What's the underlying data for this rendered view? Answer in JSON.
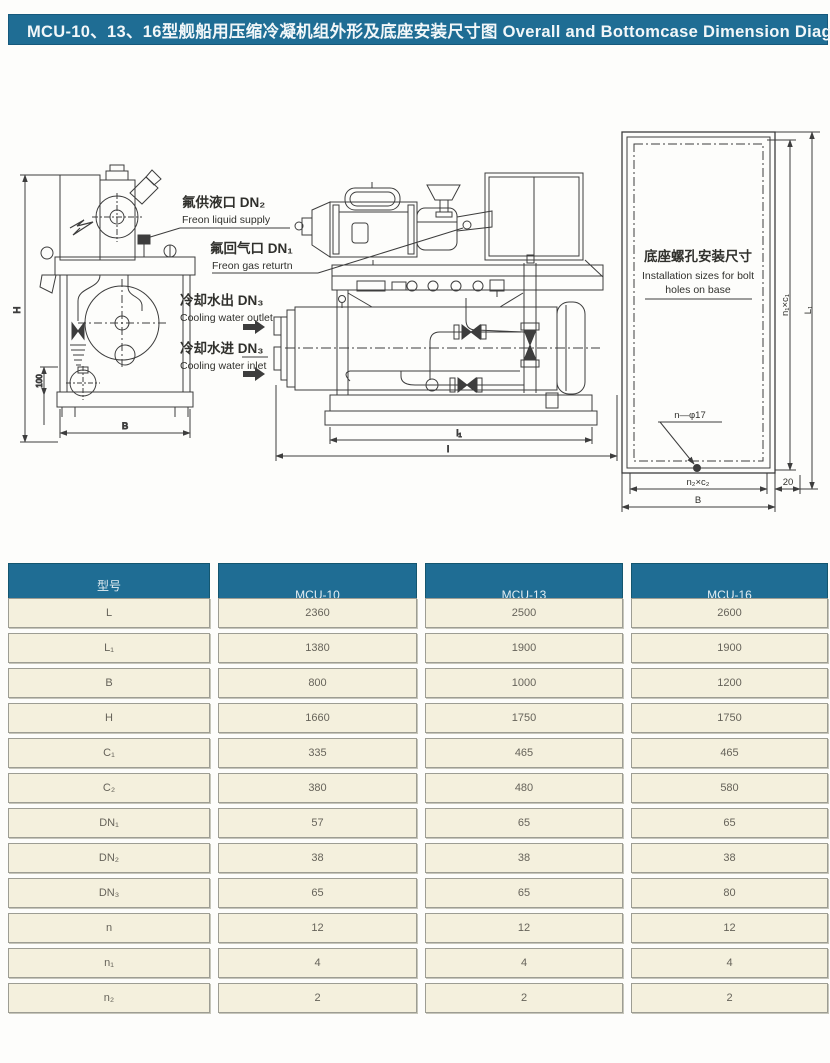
{
  "title_bar": {
    "text": "MCU-10、13、16型舰船用压缩冷凝机组外形及底座安装尺寸图 Overall and Bottomcase Dimension Diagram"
  },
  "colors": {
    "accent_blue": "#1f6d94",
    "cell_cream": "#f4f0dd",
    "drawing_line": "#3d3d3d"
  },
  "diagram": {
    "callouts": {
      "freon_liquid": {
        "zh": "氟供液口 DN₂",
        "en": "Freon liquid supply"
      },
      "freon_gas": {
        "zh": "氟回气口 DN₁",
        "en": "Freon  gas returtn"
      },
      "water_outlet": {
        "zh": "冷却水出 DN₃",
        "en": "Cooling water outlet"
      },
      "water_inlet": {
        "zh": "冷却水进 DN₃",
        "en": "Cooling water inlet"
      }
    },
    "side_view": {
      "dim_height": "H",
      "dim_width": "B",
      "dim_foot": "100"
    },
    "front_view": {
      "dim_inner": "l₁",
      "dim_outer": "l"
    },
    "base_view": {
      "title_zh": "底座螺孔安装尺寸",
      "title_en_line1": "Installation sizes for bolt",
      "title_en_line2": "holes on base",
      "bolt_callout": "n—φ17",
      "dim_bottom_inner": "n₂×c₂",
      "dim_bottom_outer": "B",
      "dim_right_inner": "n₁×c₁",
      "dim_right_outer": "L₁",
      "dim_edge": "20"
    }
  },
  "table": {
    "header": {
      "model_zh": "型号",
      "model_en": "Model",
      "models": [
        "MCU-10",
        "MCU-13",
        "MCU-16"
      ]
    },
    "rows": [
      {
        "param": "L",
        "values": [
          "2360",
          "2500",
          "2600"
        ]
      },
      {
        "param": "L₁",
        "values": [
          "1380",
          "1900",
          "1900"
        ]
      },
      {
        "param": "B",
        "values": [
          "800",
          "1000",
          "1200"
        ]
      },
      {
        "param": "H",
        "values": [
          "1660",
          "1750",
          "1750"
        ]
      },
      {
        "param": "C₁",
        "values": [
          "335",
          "465",
          "465"
        ]
      },
      {
        "param": "C₂",
        "values": [
          "380",
          "480",
          "580"
        ]
      },
      {
        "param": "DN₁",
        "values": [
          "57",
          "65",
          "65"
        ]
      },
      {
        "param": "DN₂",
        "values": [
          "38",
          "38",
          "38"
        ]
      },
      {
        "param": "DN₃",
        "values": [
          "65",
          "65",
          "80"
        ]
      },
      {
        "param": "n",
        "values": [
          "12",
          "12",
          "12"
        ]
      },
      {
        "param": "n₁",
        "values": [
          "4",
          "4",
          "4"
        ]
      },
      {
        "param": "n₂",
        "values": [
          "2",
          "2",
          "2"
        ]
      }
    ]
  }
}
